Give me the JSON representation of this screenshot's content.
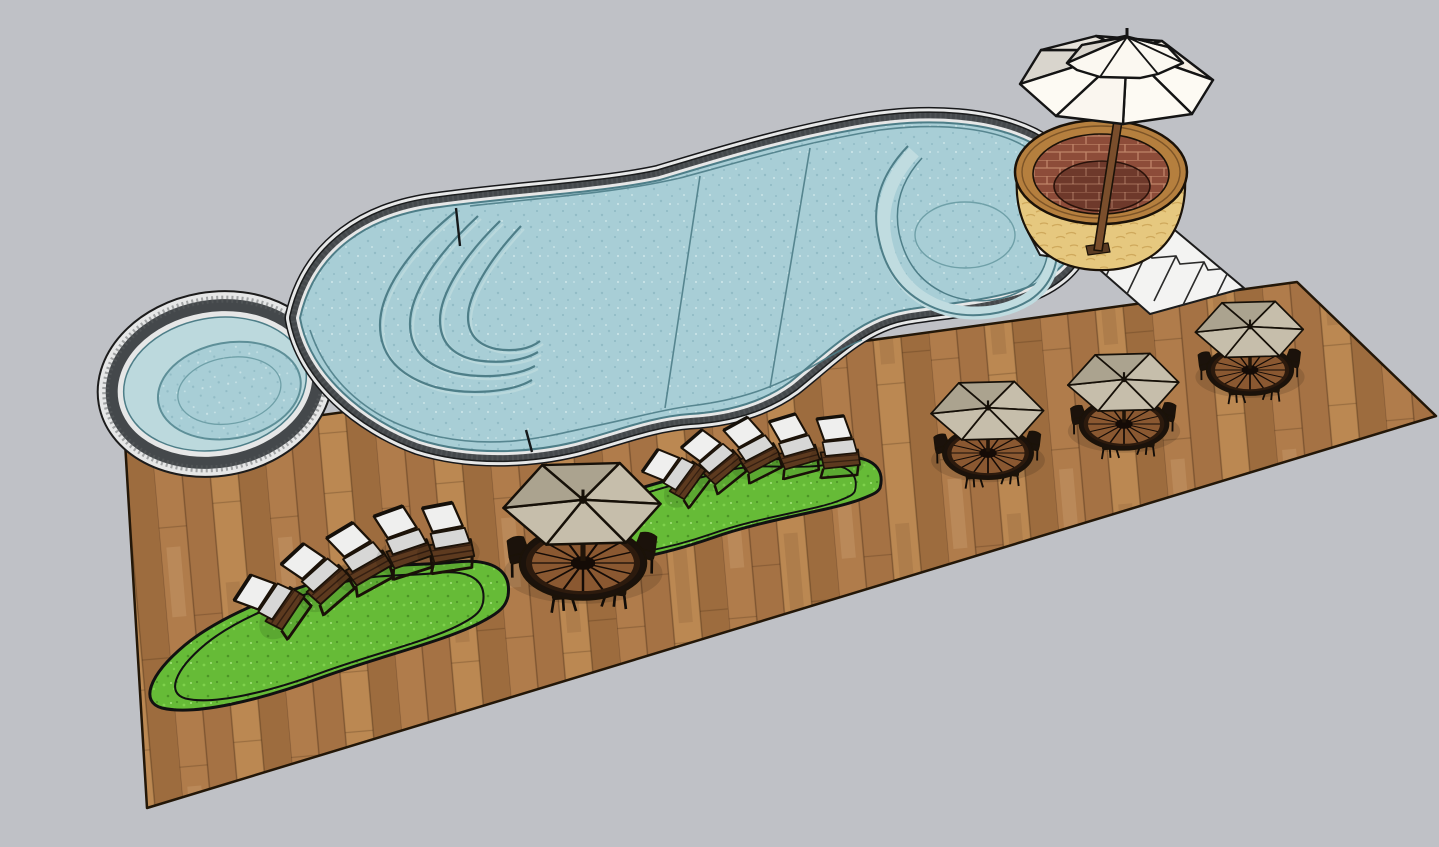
{
  "meta": {
    "kind": "3d-model-render",
    "description": "SketchUp-style 3D rendering of a backyard pool deck scene viewed from above at an angle"
  },
  "colors": {
    "bg": "#bfc1c6",
    "wood1": "#b07c4b",
    "wood2": "#a57244",
    "wood3": "#bb8852",
    "wood4": "#9d6c3e",
    "deckline": "#231708",
    "water": "#a8ced6",
    "waterdot": "#92bcc6",
    "waterline": "#4e7e88",
    "walltint": "#bcd9dd",
    "copingdark": "#44484b",
    "copinglight": "#e6e7e7",
    "grass": "#66bb37",
    "grassdot1": "#7fd24c",
    "grassdot2": "#4c9626",
    "canvaslight": "#c6beab",
    "canvasdark": "#aba38f",
    "whiteumb": "#fdfaf3",
    "creamumb": "#f6efe4",
    "grayumb": "#d9d5cd",
    "tablewood": "#8a5831",
    "darkframe": "#1b120b",
    "cushionback": "#efefee",
    "cushionseat": "#d7d7d6",
    "chaisebase": "#5d3a1f",
    "steps": "#f3f3f2",
    "stone": "#e6c87f",
    "stonedark": "#cfa95c",
    "planterwood": "#b57f3e",
    "brick": "#8d4c39",
    "brickline": "#bf8468",
    "brickfloor": "#6e392b",
    "pole": "#7a4e2c"
  },
  "objects": {
    "pool": 1,
    "round_spa": 1,
    "wood_deck": 1,
    "grass_patches": 2,
    "lounge_chairs": 10,
    "umbrella_dining_sets": 4,
    "brick_planter_with_umbrella": 1,
    "white_step_flights": 1,
    "pool_features": [
      "curved entry steps",
      "raised spa ledge",
      "stone coping"
    ]
  }
}
